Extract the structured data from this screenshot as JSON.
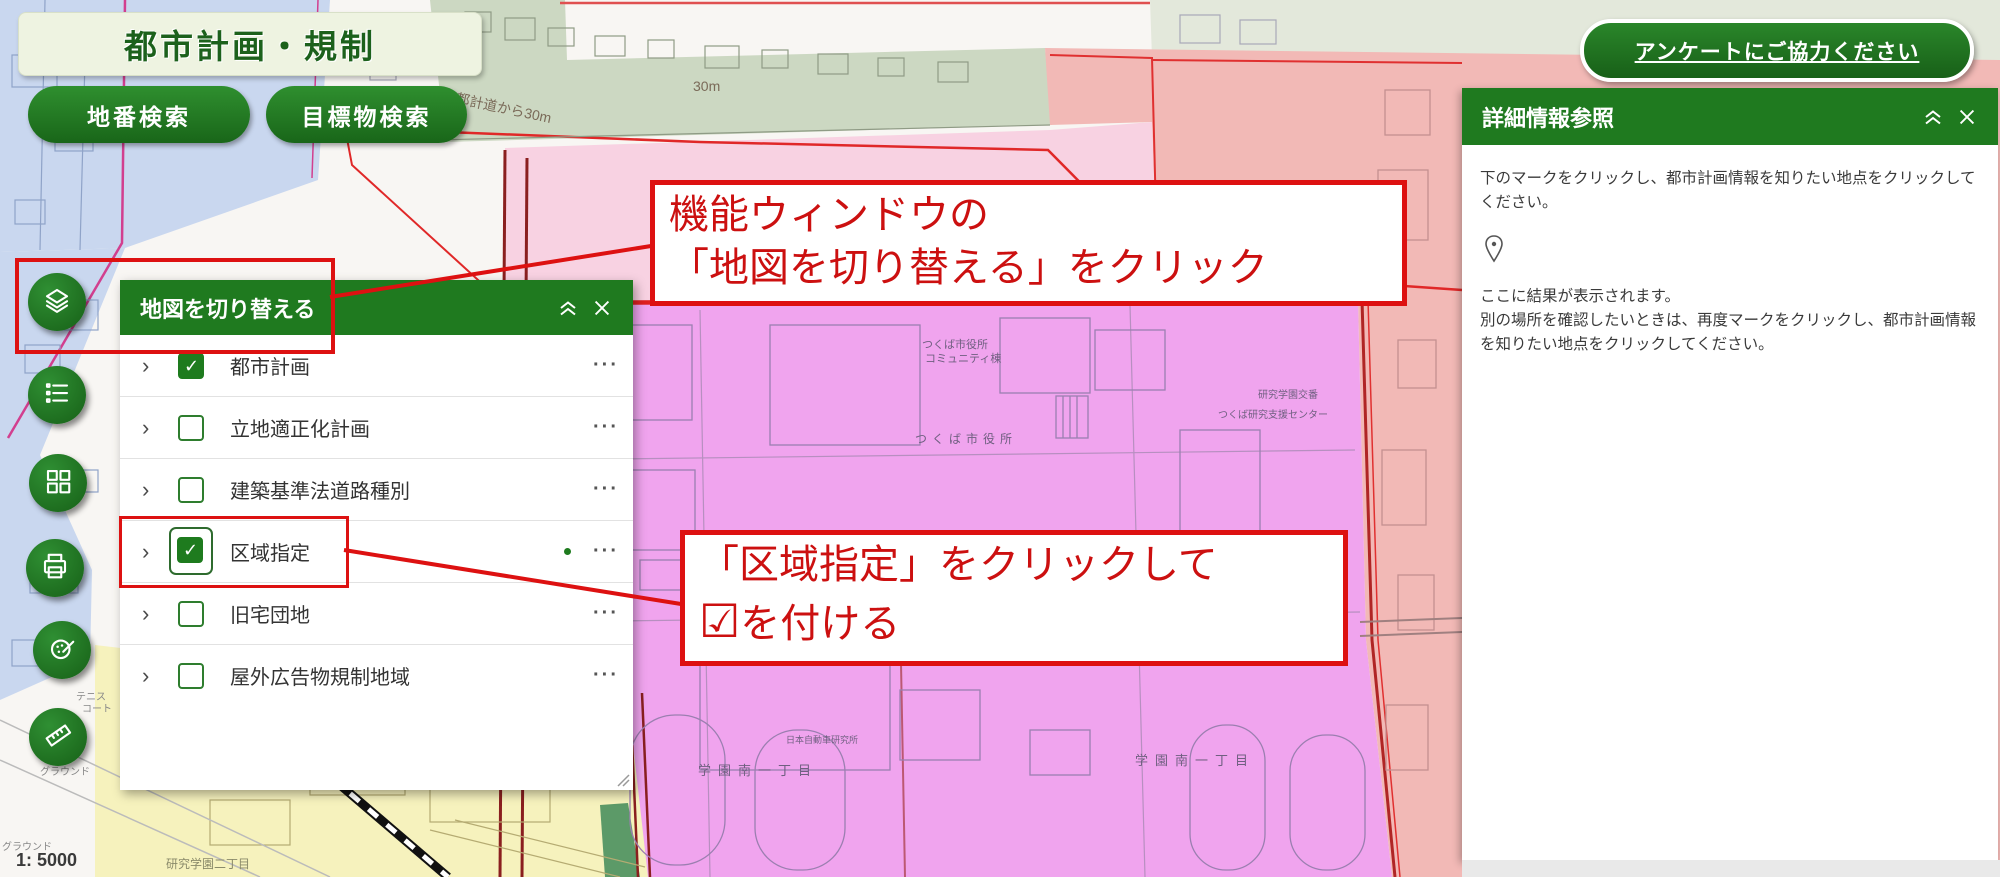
{
  "app": {
    "title": "都市計画・規制",
    "search_buttons": {
      "chiban": "地番検索",
      "landmark": "目標物検索"
    },
    "survey_button": "アンケートにご協力ください"
  },
  "toolbar": {
    "buttons": [
      {
        "name": "switch-map",
        "icon": "layers-icon"
      },
      {
        "name": "legend",
        "icon": "list-icon"
      },
      {
        "name": "map-tiles",
        "icon": "grid-icon"
      },
      {
        "name": "print",
        "icon": "printer-icon"
      },
      {
        "name": "draw",
        "icon": "palette-icon"
      },
      {
        "name": "measure",
        "icon": "ruler-icon"
      }
    ]
  },
  "layer_panel": {
    "title": "地図を切り替える",
    "items": [
      {
        "label": "都市計画",
        "checked": true,
        "has_dot": false
      },
      {
        "label": "立地適正化計画",
        "checked": false,
        "has_dot": false
      },
      {
        "label": "建築基準法道路種別",
        "checked": false,
        "has_dot": false
      },
      {
        "label": "区域指定",
        "checked": true,
        "has_dot": true
      },
      {
        "label": "旧宅団地",
        "checked": false,
        "has_dot": false
      },
      {
        "label": "屋外広告物規制地域",
        "checked": false,
        "has_dot": false
      }
    ]
  },
  "info_panel": {
    "title": "詳細情報参照",
    "instruction": "下のマークをクリックし、都市計画情報を知りたい地点をクリックしてください。",
    "result_hint_1": "ここに結果が表示されます。",
    "result_hint_2": "別の場所を確認したいときは、再度マークをクリックし、都市計画情報を知りたい地点をクリックしてください。"
  },
  "annotations": {
    "note1_line1": "機能ウィンドウの",
    "note1_line2": "「地図を切り替える」をクリック",
    "note2_line1": "「区域指定」をクリックして",
    "note2_line2": "を付ける",
    "note2_check": "☑"
  },
  "map": {
    "scale": "1: 5000",
    "labels": [
      {
        "text": "都計道から30m"
      },
      {
        "text": "30m"
      },
      {
        "text": "つくば市役所"
      },
      {
        "text": "コミュニティ棟"
      },
      {
        "text": "つくば市役所"
      },
      {
        "text": "研究学園交番"
      },
      {
        "text": "つくば研究支援センター"
      },
      {
        "text": "学園南一丁目"
      },
      {
        "text": "学園南一丁目"
      },
      {
        "text": "日本自動車研究所"
      },
      {
        "text": "テニス"
      },
      {
        "text": "コート"
      },
      {
        "text": "グラウンド"
      },
      {
        "text": "グラウンド"
      },
      {
        "text": "研究学園二丁目"
      }
    ]
  },
  "colors": {
    "brand_green": "#1f7a1f",
    "annotation_red": "#dd1111",
    "zone_magenta": "#f0a4ee",
    "zone_pink": "#f8d2e2",
    "zone_salmon": "#f2b9b6",
    "zone_yellow": "#f6f2bd",
    "zone_blue": "#c9d7ef",
    "zone_green": "#ccd8c2"
  }
}
